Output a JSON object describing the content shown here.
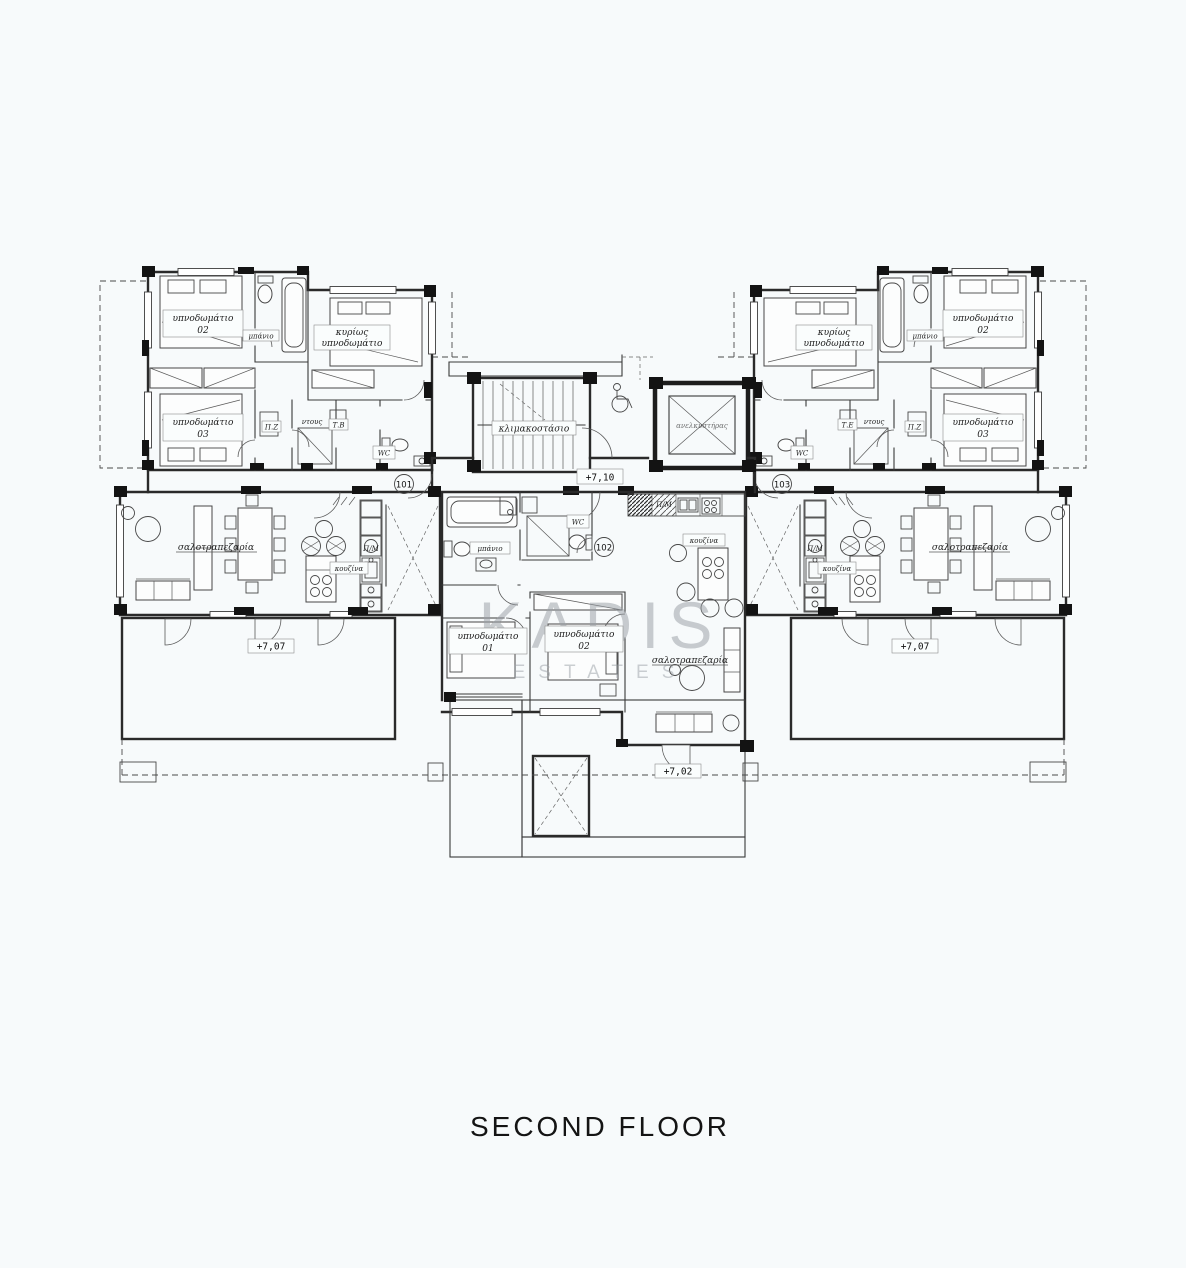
{
  "page": {
    "title": "SECOND FLOOR",
    "background": "#f7fafb",
    "line_color": "#2a2a2a"
  },
  "watermark": {
    "brand": "KADIS",
    "sub": "ESTATES",
    "color": "#9aa0a6"
  },
  "labels": {
    "bedroom": "υπνοδωμάτιο",
    "master_l1": "κυρίως",
    "bathroom": "μπάνιο",
    "shower": "ντους",
    "wc": "WC",
    "kitchen": "κουζίνα",
    "living": "σαλοτραπεζαρία",
    "staircase": "κλιμακοστάσιο",
    "elevator": "ανελκυστήρας",
    "washer": "Π/Μ",
    "pz": "Π.Ζ",
    "tb": "Τ.Β",
    "te": "Τ.Ε",
    "n01": "01",
    "n02": "02",
    "n03": "03"
  },
  "levels": {
    "core": "+7,10",
    "side": "+7,07",
    "center": "+7,02"
  },
  "units": {
    "left": "101",
    "center": "102",
    "right": "103"
  }
}
